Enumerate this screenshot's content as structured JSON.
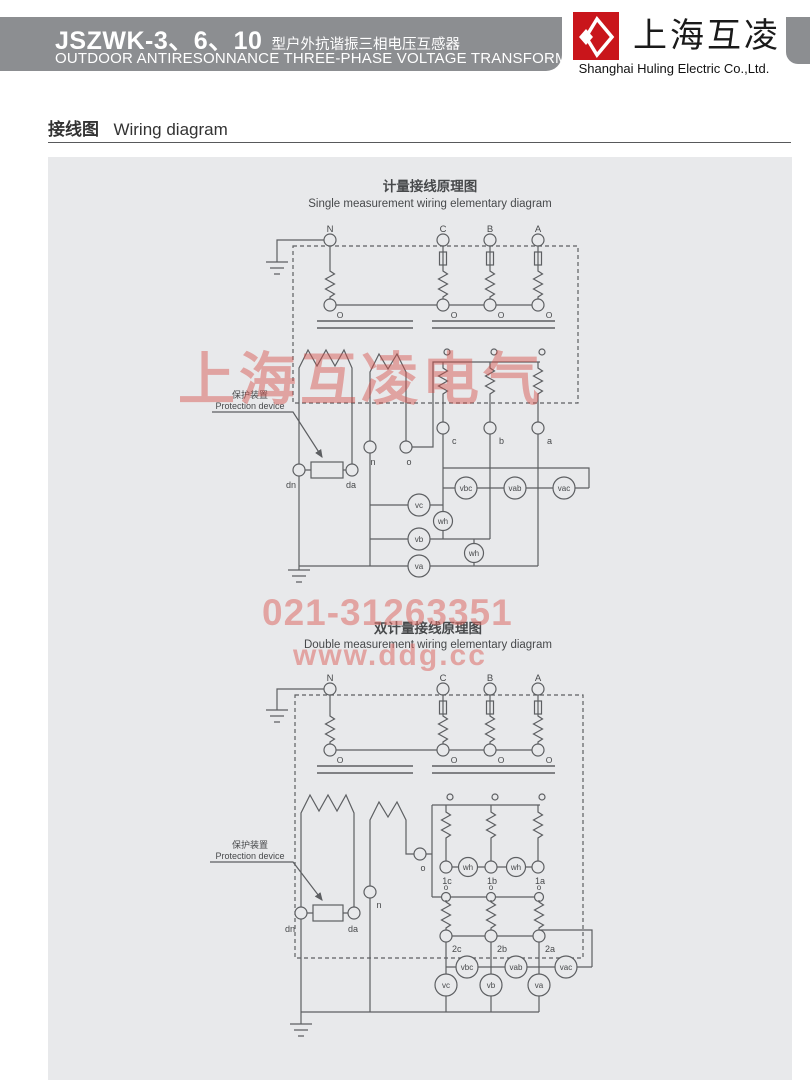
{
  "header": {
    "model": "JSZWK-3、6、10",
    "model_suffix": "型户外抗谐振三相电压互感器",
    "subtitle": "OUTDOOR ANTIRESONNANCE THREE-PHASE VOLTAGE TRANSFORMER",
    "logo_text": "上海互凌",
    "company": "Shanghai Huling Electric Co.,Ltd."
  },
  "section": {
    "title_zh": "接线图",
    "title_en": "Wiring diagram"
  },
  "watermarks": {
    "brand": "上海互凌电气",
    "phone": "021-31263351",
    "site": "www.ddg.cc"
  },
  "diagram1": {
    "title_zh": "计量接线原理图",
    "title_en": "Single measurement wiring elementary diagram"
  },
  "diagram2": {
    "title_zh": "双计量接线原理图",
    "title_en": "Double measurement wiring elementary diagram"
  },
  "protection": {
    "zh": "保护装置",
    "en": "Protection device"
  },
  "labels": {
    "N": "N",
    "C": "C",
    "B": "B",
    "A": "A",
    "O": "O",
    "o": "o",
    "n": "n",
    "c": "c",
    "b": "b",
    "a": "a",
    "dn": "dn",
    "da": "da",
    "c1": "1c",
    "b1": "1b",
    "a1": "1a",
    "c2": "2c",
    "b2": "2b",
    "a2": "2a"
  },
  "meters": {
    "vc": "vc",
    "vb": "vb",
    "va": "va",
    "wh": "wh",
    "vbc": "vbc",
    "vab": "vab",
    "vac": "vac"
  },
  "colors": {
    "accent_red": "#c9151b",
    "header_gray": "#8c8e91",
    "panel_bg": "#e8e9eb",
    "line": "#5d5f62",
    "watermark_red": "#d84e48"
  }
}
